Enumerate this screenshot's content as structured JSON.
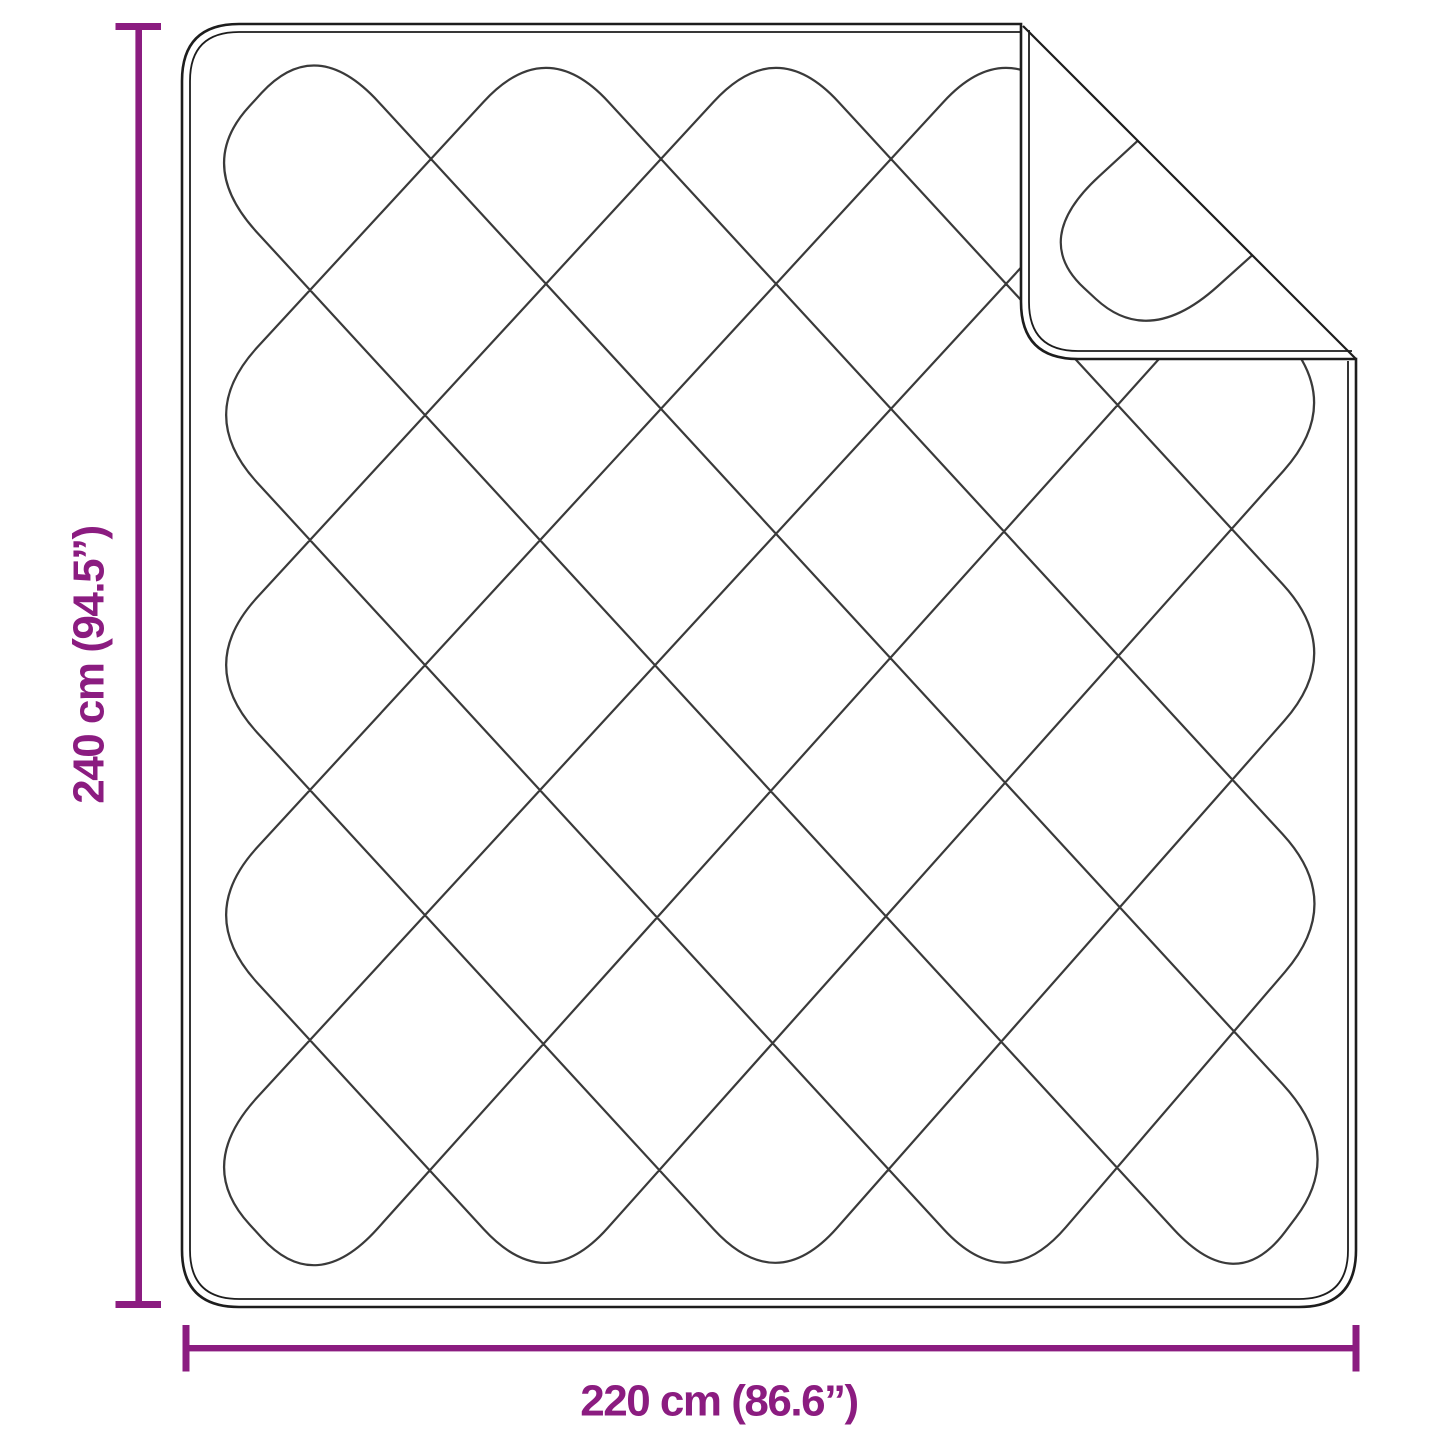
{
  "diagram": {
    "height_label": "240 cm (94.5”)",
    "width_label": "220 cm (86.6”)",
    "colors": {
      "dimension": "#8B1C80",
      "outline": "#1d1d1d",
      "stitch": "#3a3a3a",
      "background": "#ffffff"
    }
  }
}
